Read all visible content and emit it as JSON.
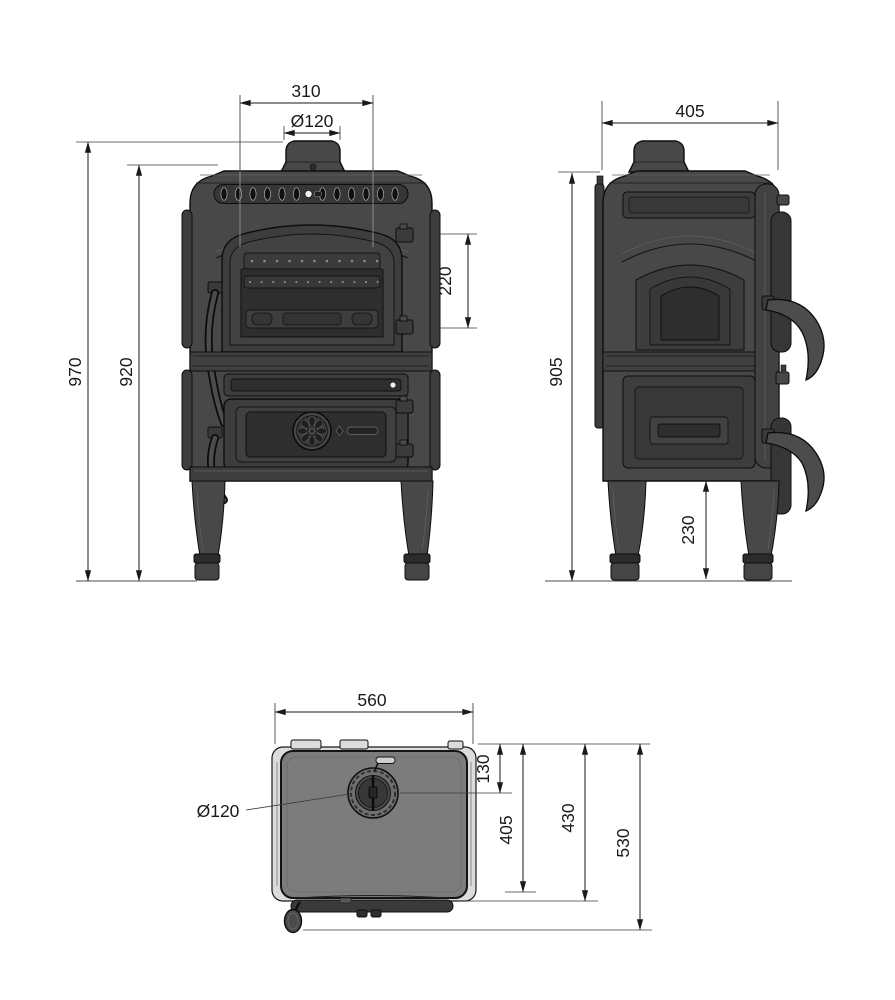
{
  "palette": {
    "background": "#ffffff",
    "line": "#1a1a1a",
    "edge": "#0d0d0d",
    "body": "#484848",
    "panel": "#3d3d3d",
    "recess": "#2e2e2e",
    "band": "#363636",
    "plate": "#7c7c7c",
    "rail": "#dcdcdc",
    "accent_white": "#f0f0f0"
  },
  "views": {
    "front": {
      "dimensions": {
        "top_width": "310",
        "flue_diameter": "Ø120",
        "glass_height": "220",
        "overall_height": "970",
        "body_height": "920"
      }
    },
    "side": {
      "dimensions": {
        "depth": "405",
        "body_height": "905",
        "leg_clearance": "230"
      }
    },
    "top": {
      "dimensions": {
        "width": "560",
        "flue_center_offset": "130",
        "flue_diameter": "Ø120",
        "plate_depth": "405",
        "body_depth": "430",
        "overall_depth": "530"
      }
    }
  }
}
